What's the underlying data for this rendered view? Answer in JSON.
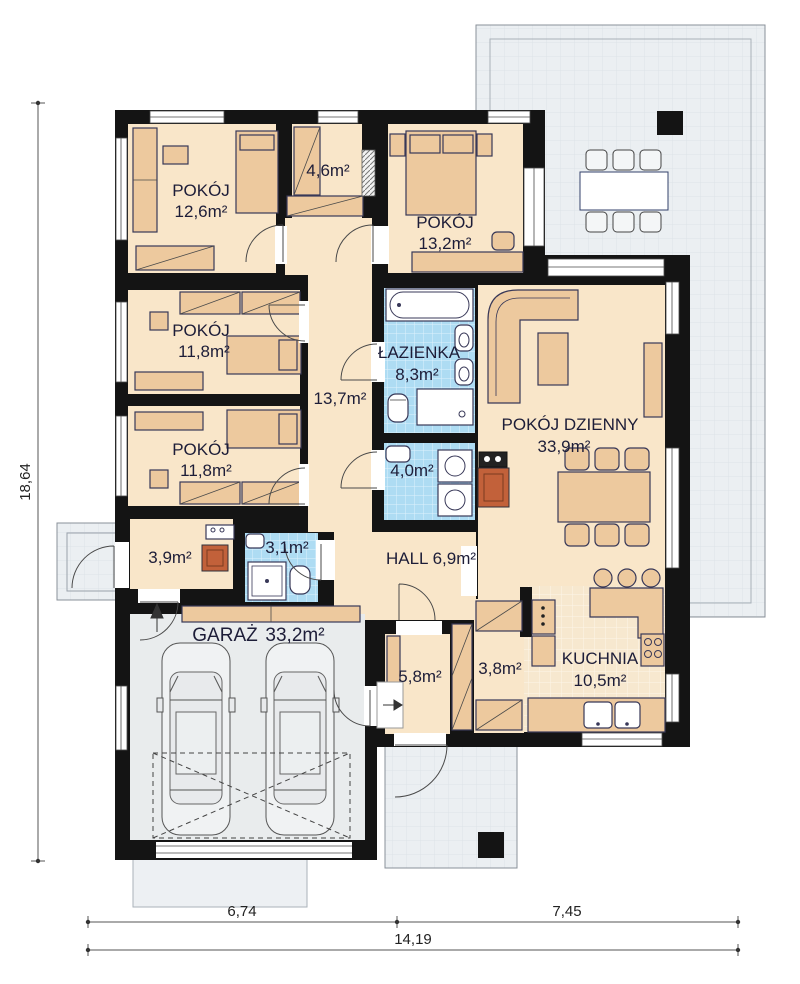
{
  "rooms": {
    "bedroom1": {
      "name": "POKÓJ",
      "area": "12,6m²"
    },
    "closet": {
      "area": "4,6m²"
    },
    "bedroom2": {
      "name": "POKÓJ",
      "area": "13,2m²"
    },
    "bedroom3": {
      "name": "POKÓJ",
      "area": "11,8m²"
    },
    "bedroom4": {
      "name": "POKÓJ",
      "area": "11,8m²"
    },
    "corridor": {
      "area": "13,7m²"
    },
    "bathroom": {
      "name": "ŁAZIENKA",
      "area": "8,3m²"
    },
    "laundry": {
      "area": "4,0m²"
    },
    "living": {
      "name": "POKÓJ DZIENNY",
      "area": "33,9m²"
    },
    "utility": {
      "area": "3,9m²"
    },
    "wc": {
      "area": "3,1m²"
    },
    "hall": {
      "label": "HALL 6,9m²"
    },
    "garage": {
      "name": "GARAŻ",
      "area": "33,2m²"
    },
    "vestibule": {
      "area": "5,8m²"
    },
    "pantry": {
      "area": "3,8m²"
    },
    "kitchen": {
      "name": "KUCHNIA",
      "area": "10,5m²"
    }
  },
  "dimensions": {
    "height_total": "18,64",
    "bottom_left": "6,74",
    "bottom_right": "7,45",
    "bottom_total": "14,19"
  },
  "colors": {
    "wall": "#141414",
    "room_floor": "#f9e6c9",
    "furniture": "#edc99e",
    "tile_blue": "#aedcf3",
    "terrace": "#ebeff2",
    "garage_floor": "#e9eced",
    "fireplace": "#c2613a"
  }
}
